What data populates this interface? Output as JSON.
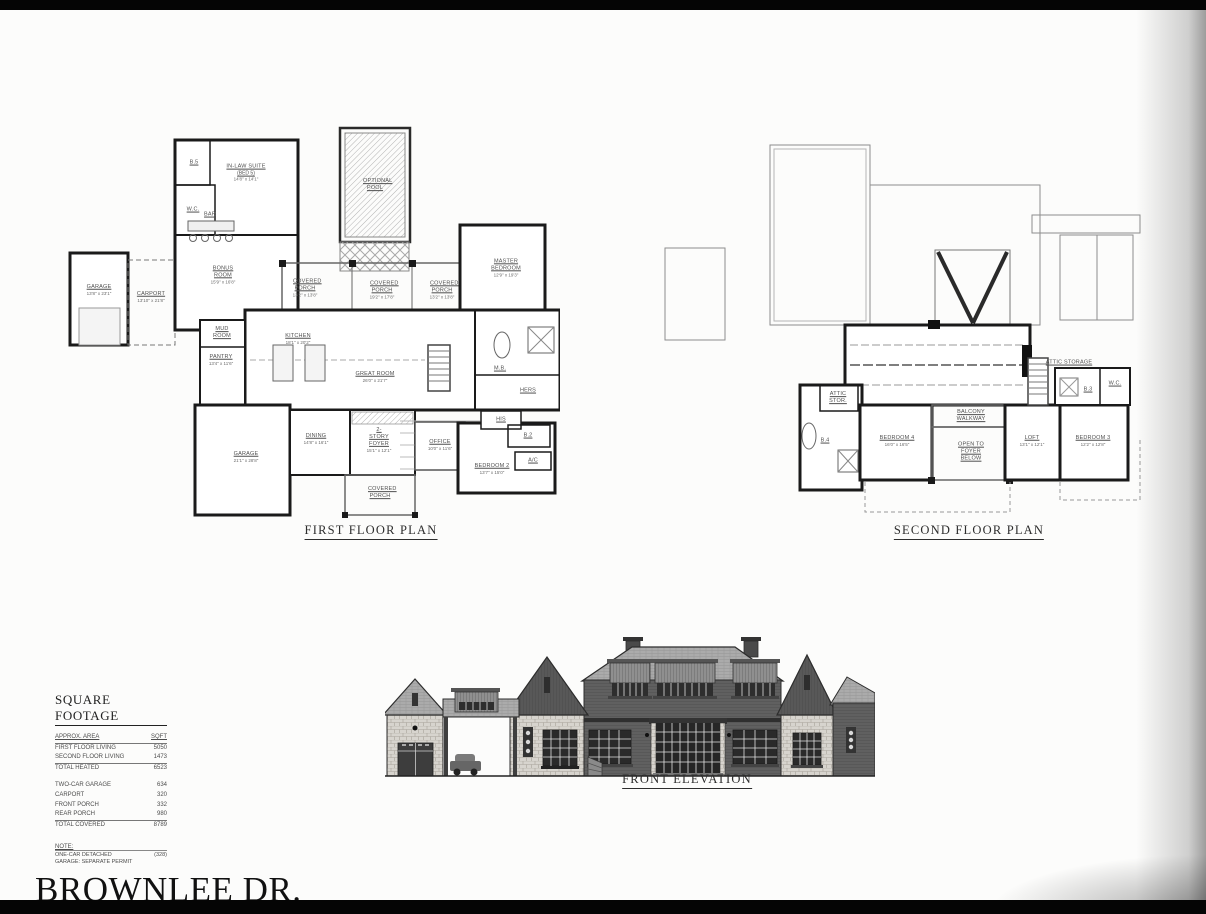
{
  "sheet": {
    "title": "BROWNLEE DR."
  },
  "first_floor": {
    "title": "FIRST FLOOR PLAN",
    "rooms": {
      "b5": {
        "name": "B.5"
      },
      "wc": {
        "name": "W.C."
      },
      "inlaw": {
        "name": "IN-LAW SUITE",
        "sub": "(BED 5)",
        "dims": "14'8\" x 14'1\""
      },
      "bar": {
        "name": "BAR"
      },
      "bonus": {
        "name": "BONUS ROOM",
        "dims": "15'9\" x 16'8\""
      },
      "garage_detached": {
        "name": "GARAGE",
        "dims": "13'8\" x 23'1\""
      },
      "carport": {
        "name": "CARPORT",
        "dims": "13'10\" x 21'8\""
      },
      "mud": {
        "name": "MUD ROOM"
      },
      "pantry": {
        "name": "PANTRY",
        "dims": "13'4\" x 11'6\""
      },
      "kitchen": {
        "name": "KITCHEN",
        "dims": "18'1\" x 20'2\""
      },
      "porch_left": {
        "name": "COVERED PORCH",
        "dims": "13'2\" x 13'8\""
      },
      "porch_center": {
        "name": "COVERED PORCH",
        "dims": "19'2\" x 17'8\""
      },
      "porch_right": {
        "name": "COVERED PORCH",
        "dims": "13'2\" x 13'8\""
      },
      "pool": {
        "name": "OPTIONAL POOL"
      },
      "great": {
        "name": "GREAT ROOM",
        "dims": "26'0\" x 21'7\""
      },
      "master": {
        "name": "MASTER BEDROOM",
        "dims": "12'9\" x 19'3\""
      },
      "mb": {
        "name": "M.B."
      },
      "hers": {
        "name": "HERS"
      },
      "his": {
        "name": "HIS"
      },
      "b2": {
        "name": "B.2"
      },
      "ac": {
        "name": "A/C"
      },
      "office": {
        "name": "OFFICE",
        "dims": "10'0\" x 11'6\""
      },
      "bedroom2": {
        "name": "BEDROOM 2",
        "dims": "13'7\" x 15'0\""
      },
      "dining": {
        "name": "DINING",
        "dims": "14'8\" x 16'1\""
      },
      "foyer": {
        "name": "2-STORY FOYER",
        "dims": "15'1\" x 12'1\""
      },
      "garage_attached": {
        "name": "GARAGE",
        "dims": "21'1\" x 28'8\""
      },
      "porch_front": {
        "name": "COVERED PORCH"
      }
    }
  },
  "second_floor": {
    "title": "SECOND FLOOR PLAN",
    "rooms": {
      "attic_stor": {
        "name": "ATTIC STOR."
      },
      "b4": {
        "name": "B.4"
      },
      "bedroom4": {
        "name": "BEDROOM 4",
        "dims": "16'0\" x 16'5\""
      },
      "balcony": {
        "name": "BALCONY WALKWAY"
      },
      "open_foyer": {
        "name": "OPEN TO FOYER BELOW"
      },
      "loft": {
        "name": "LOFT",
        "dims": "13'1\" x 12'1\""
      },
      "bedroom3": {
        "name": "BEDROOM 3",
        "dims": "12'2\" x 12'8\""
      },
      "attic_storage": {
        "name": "ATTIC STORAGE"
      },
      "b3": {
        "name": "B.3"
      },
      "wc": {
        "name": "W.C."
      }
    }
  },
  "elevation": {
    "title": "FRONT ELEVATION"
  },
  "square_footage": {
    "title": "SQUARE FOOTAGE",
    "header": {
      "area": "APPROX. AREA",
      "sqft": "SQFT"
    },
    "rows_heated": [
      {
        "label": "FIRST FLOOR LIVING",
        "value": "5050"
      },
      {
        "label": "SECOND FLOOR LIVING",
        "value": "1473"
      },
      {
        "label": "TOTAL HEATED",
        "value": "6523"
      }
    ],
    "rows_covered": [
      {
        "label": "TWO-CAR GARAGE",
        "value": "634"
      },
      {
        "label": "CARPORT",
        "value": "320"
      },
      {
        "label": "FRONT PORCH",
        "value": "332"
      },
      {
        "label": "REAR PORCH",
        "value": "980"
      },
      {
        "label": "TOTAL COVERED",
        "value": "8789"
      }
    ],
    "note_label": "NOTE:",
    "note_text": "ONE-CAR DETACHED GARAGE: SEPARATE PERMIT",
    "note_value": "(328)"
  }
}
